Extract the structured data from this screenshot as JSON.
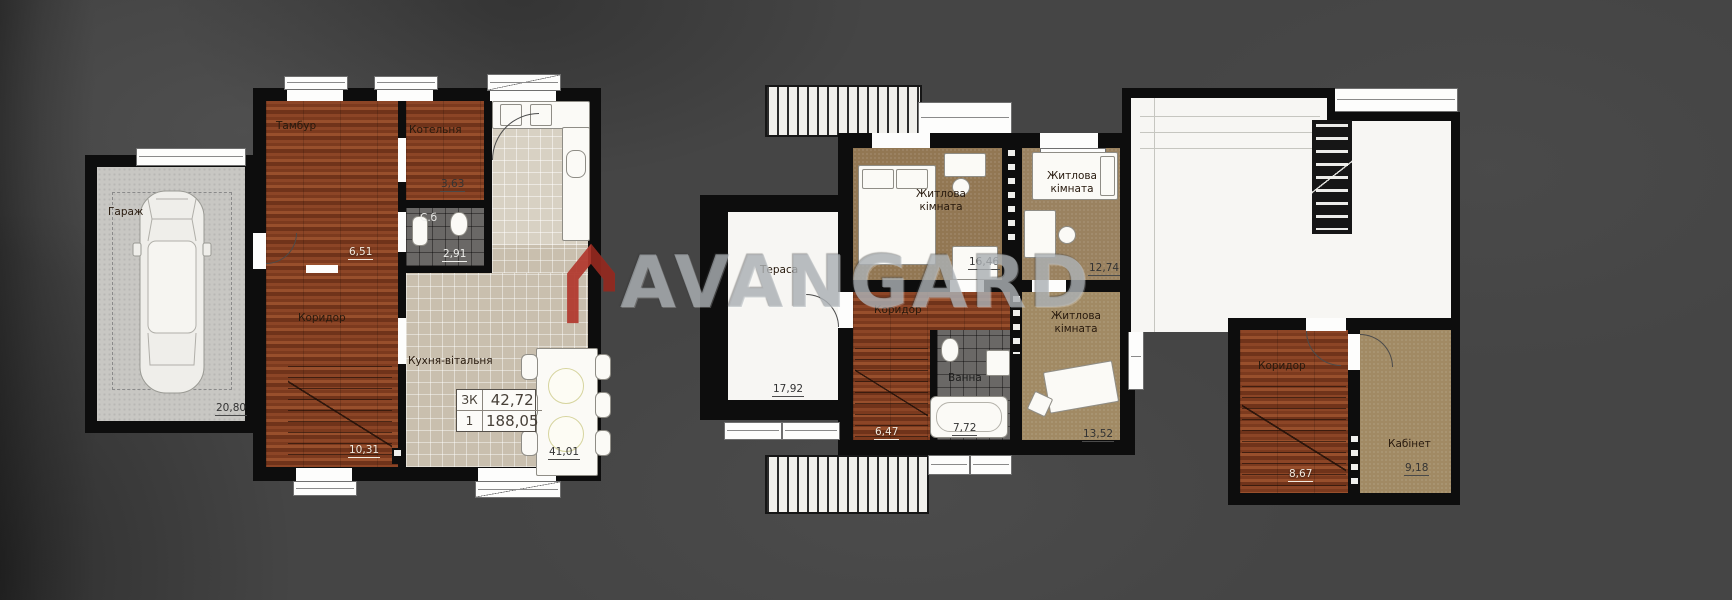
{
  "watermark": {
    "brand_text": "AVANGARD",
    "logo_color": "#b2392e",
    "text_color": "rgba(183,189,194,0.62)"
  },
  "plans": {
    "floor1": {
      "garage": {
        "label": "Гараж",
        "area": "20,80"
      },
      "tambour": {
        "label": "Тамбур",
        "area": "6,51"
      },
      "boiler": {
        "label": "Котельня",
        "area": "3,63"
      },
      "wc": {
        "label": "С.б",
        "area": "2,91"
      },
      "corridor": {
        "label": "Коридор",
        "area": "10,31"
      },
      "kitchen": {
        "label": "Кухня-вітальня",
        "area": "41,01"
      },
      "info": {
        "rooms_code": "ЗК",
        "living_area": "42,72",
        "floors": "1",
        "total_area": "188,05"
      }
    },
    "floor2": {
      "terrace": {
        "label": "Тераса",
        "area": "17,92"
      },
      "bedroom1": {
        "label": "Житлова кімната",
        "area": "16,46"
      },
      "bedroom2": {
        "label": "Житлова кімната",
        "area": "12,74"
      },
      "corridor": {
        "label": "Коридор",
        "area": "6,47"
      },
      "bath": {
        "label": "Ванна",
        "area": "7,72"
      },
      "bedroom3": {
        "label": "Житлова кімната",
        "area": "13,52"
      }
    },
    "floor3": {
      "corridor": {
        "label": "Коридор",
        "area": "8,67"
      },
      "office": {
        "label": "Кабінет",
        "area": "9,18"
      }
    }
  }
}
